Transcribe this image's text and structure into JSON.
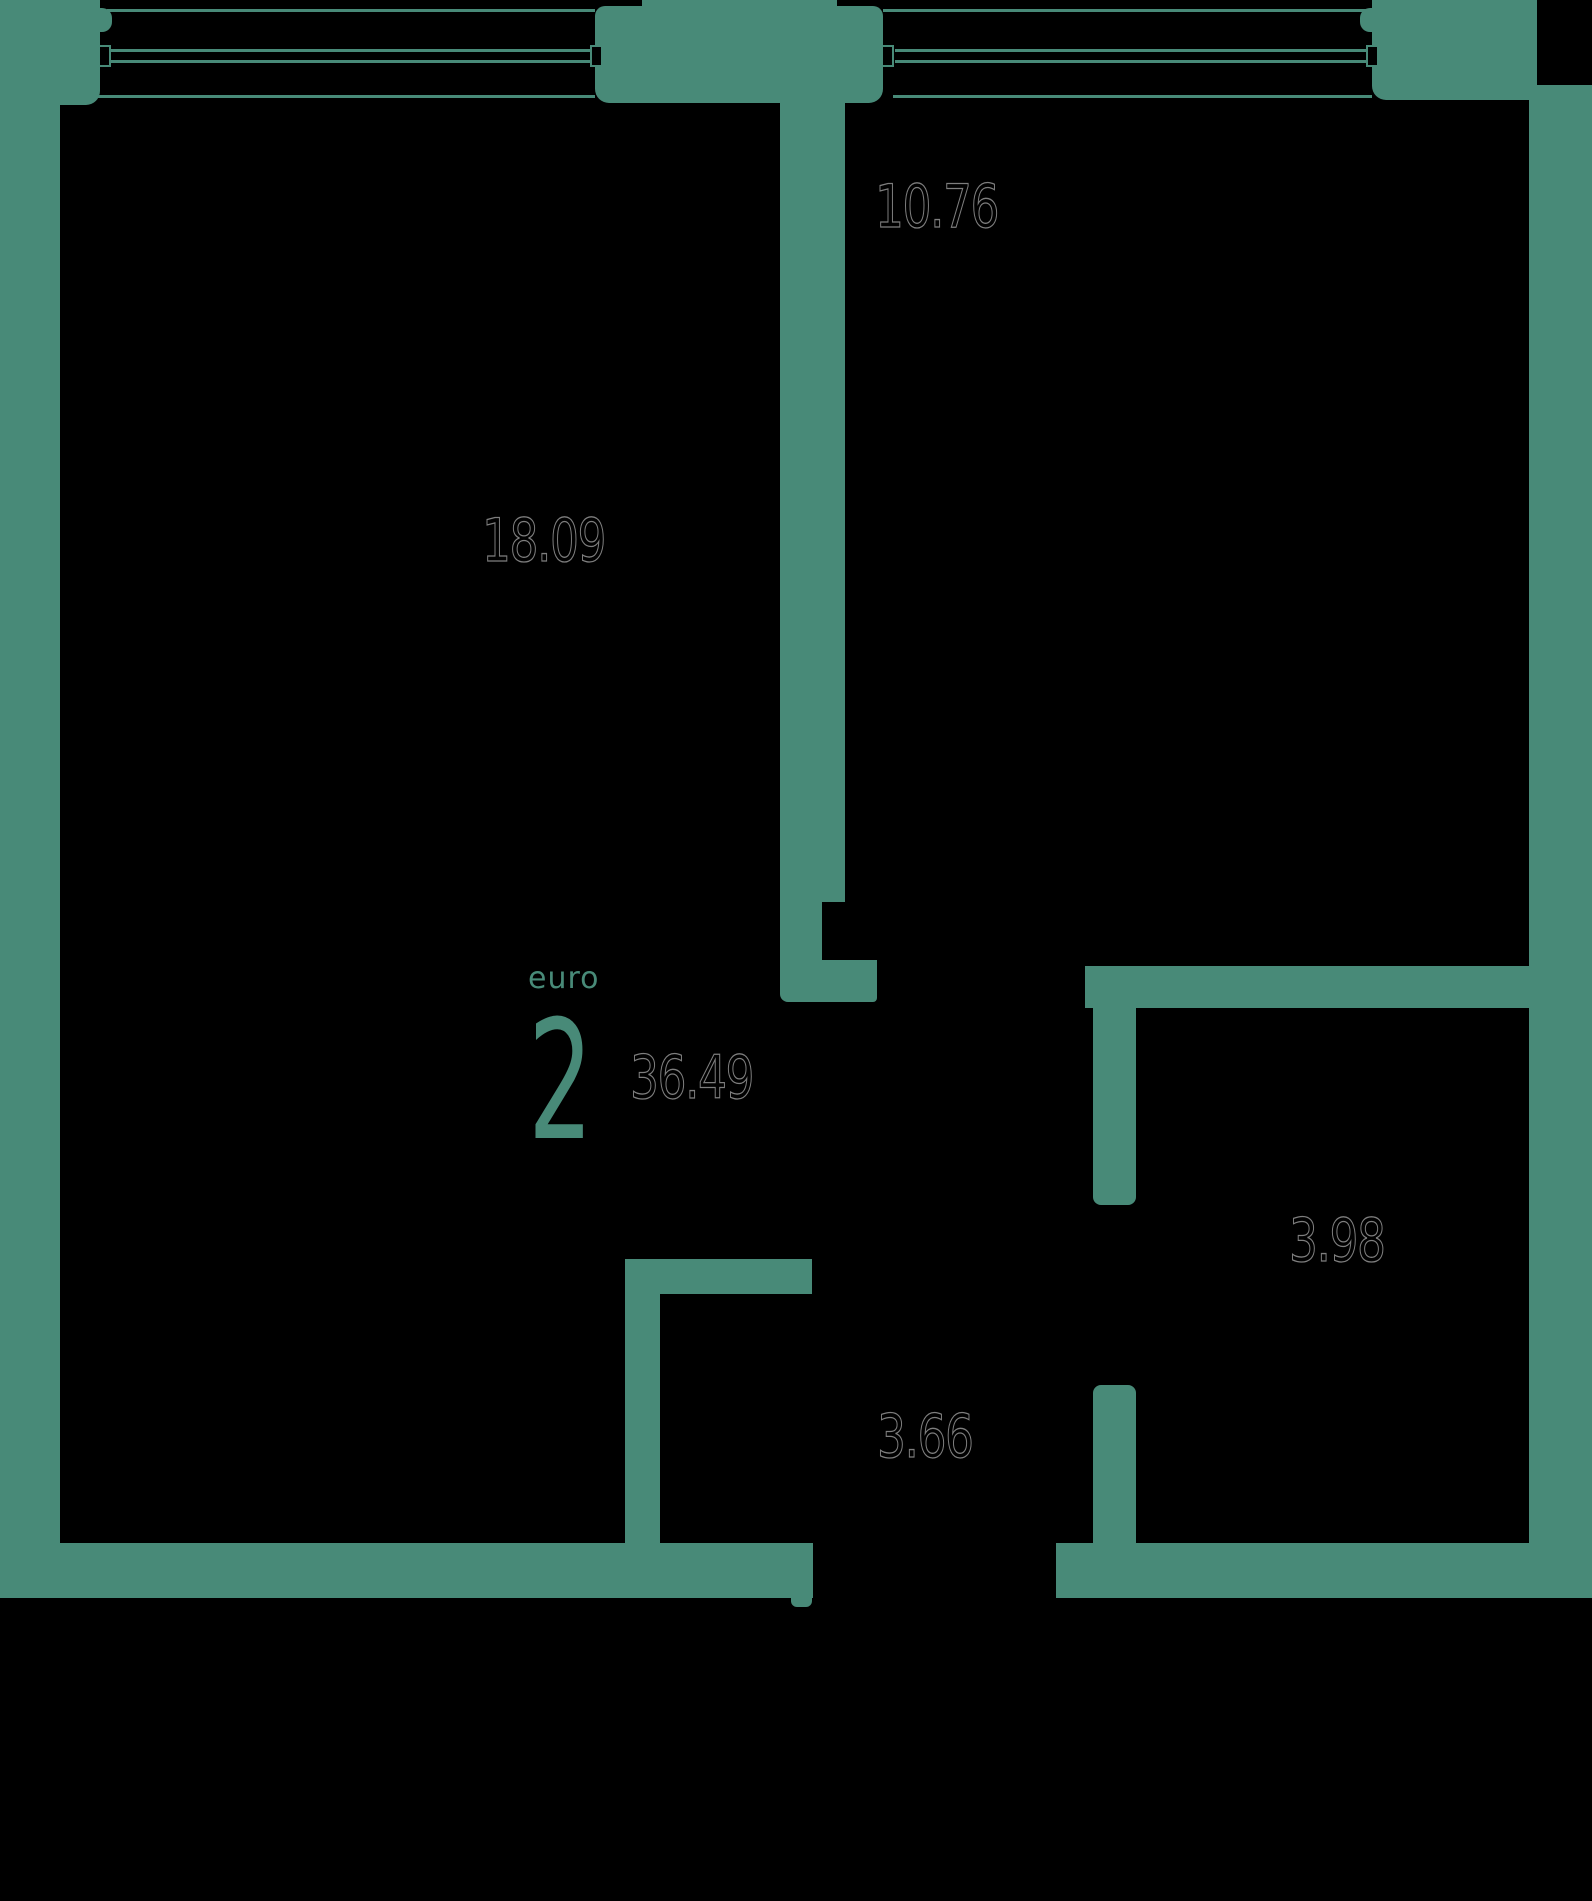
{
  "plan": {
    "unit_type_label": "euro",
    "unit_room_count": "2",
    "total_area": "36.49",
    "rooms": {
      "living": {
        "area": "18.09"
      },
      "bedroom": {
        "area": "10.76"
      },
      "bath": {
        "area": "3.98"
      },
      "hall": {
        "area": "3.66"
      }
    },
    "colors": {
      "background": "#000000",
      "wall": "#488a78",
      "area_text_outline": "#7e7e7e",
      "accent_text": "#488a78"
    }
  }
}
